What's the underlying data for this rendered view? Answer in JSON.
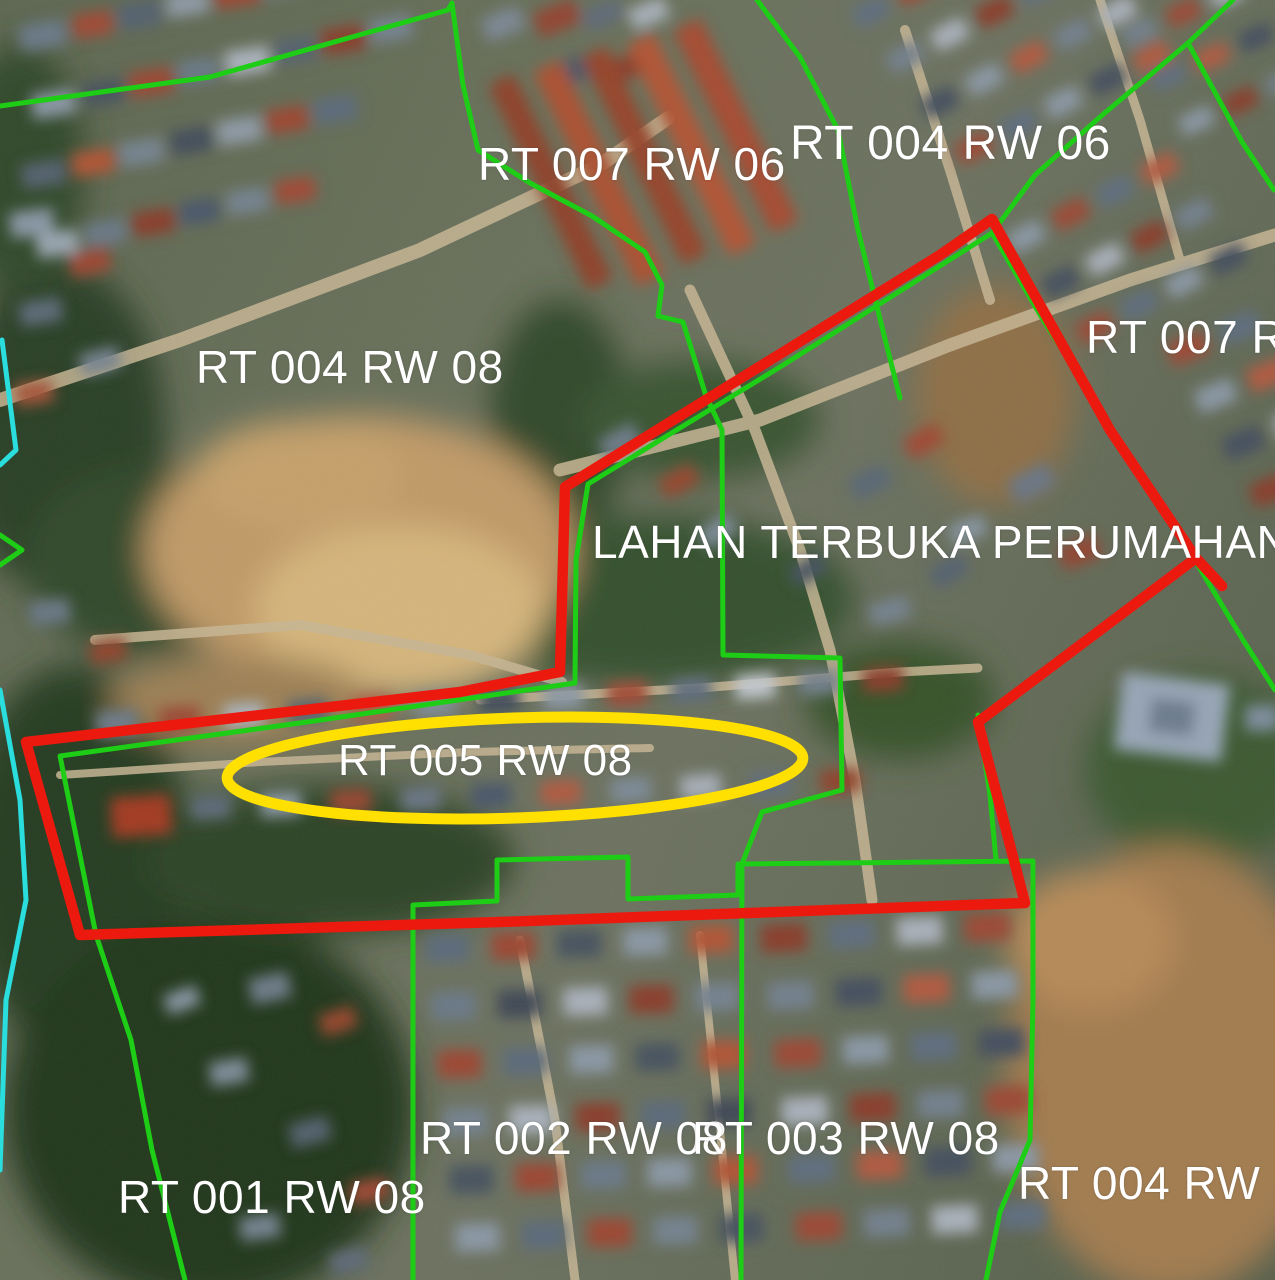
{
  "map": {
    "description": "Aerial satellite view of a neighborhood with RT/RW administrative boundaries",
    "labels": {
      "rt007rw06": "RT 007 RW 06",
      "rt004rw06": "RT 004 RW 06",
      "rt004rw08": "RT 004 RW 08",
      "rt007rw_right": "RT 007 RW",
      "lahan": "LAHAN TERBUKA PERUMAHAN",
      "rt005rw08": "RT 005 RW 08",
      "rt002rw08": "RT 002 RW 08",
      "rt003rw08": "RT 003 RW 08",
      "rt001rw08": "RT 001 RW 08",
      "rt004rw_bottom": "RT 004 RW"
    },
    "colors": {
      "boundary_green": "#1ecd16",
      "highlight_red": "#ec1a0e",
      "highlight_yellow": "#ffe000",
      "line_cyan": "#2adedd",
      "label_white": "#ffffff"
    }
  }
}
